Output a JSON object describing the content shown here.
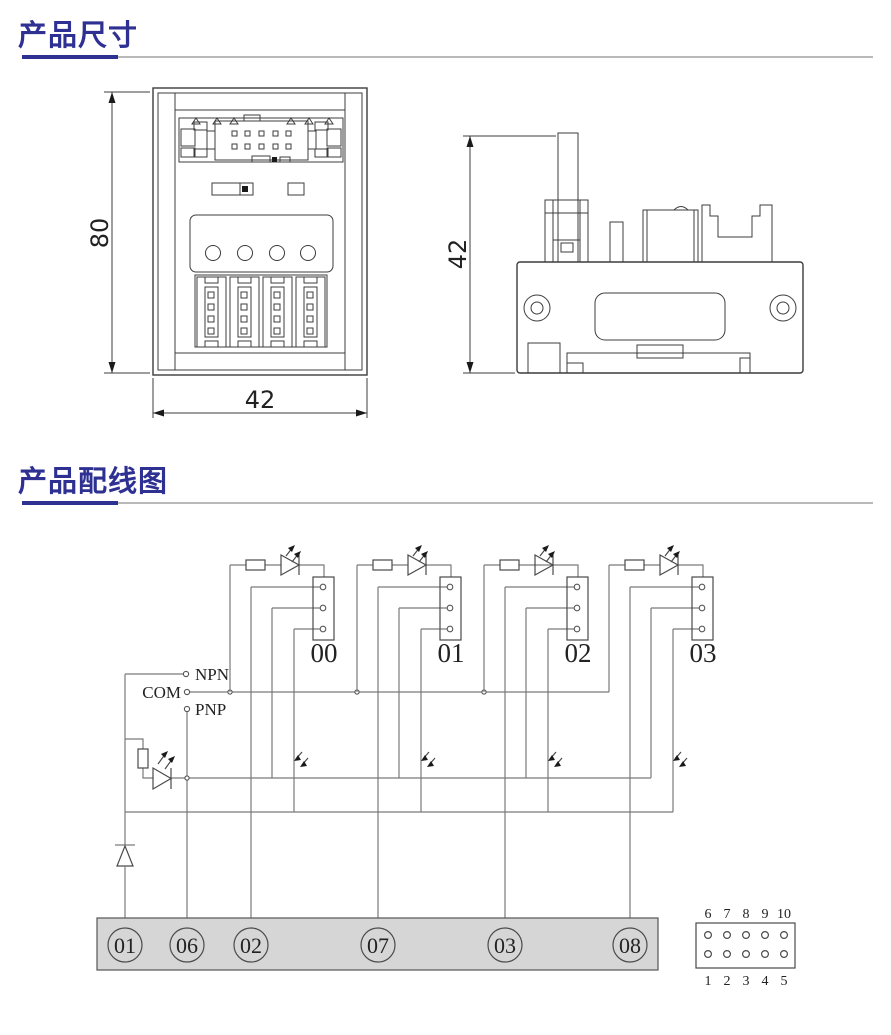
{
  "sections": [
    {
      "title": "产品尺寸"
    },
    {
      "title": "产品配线图"
    }
  ],
  "colors": {
    "accent": "#2e3192",
    "rule_gray": "#b9b9b9",
    "drawing_line": "#3c3c3c",
    "wire_line": "#7a7a7a",
    "terminal_strip_fill": "#d6d6d6"
  },
  "front_view": {
    "height_dim": "80",
    "width_dim": "42"
  },
  "side_view": {
    "height_dim": "42"
  },
  "wiring": {
    "input_labels": {
      "npn": "NPN",
      "com": "COM",
      "pnp": "PNP"
    },
    "channels": [
      {
        "label": "00"
      },
      {
        "label": "01"
      },
      {
        "label": "02"
      },
      {
        "label": "03"
      }
    ],
    "terminals": [
      {
        "label": "01"
      },
      {
        "label": "06"
      },
      {
        "label": "02"
      },
      {
        "label": "07"
      },
      {
        "label": "03"
      },
      {
        "label": "08"
      }
    ],
    "pin_header": {
      "top": [
        "6",
        "7",
        "8",
        "9",
        "10"
      ],
      "bottom": [
        "1",
        "2",
        "3",
        "4",
        "5"
      ]
    }
  }
}
